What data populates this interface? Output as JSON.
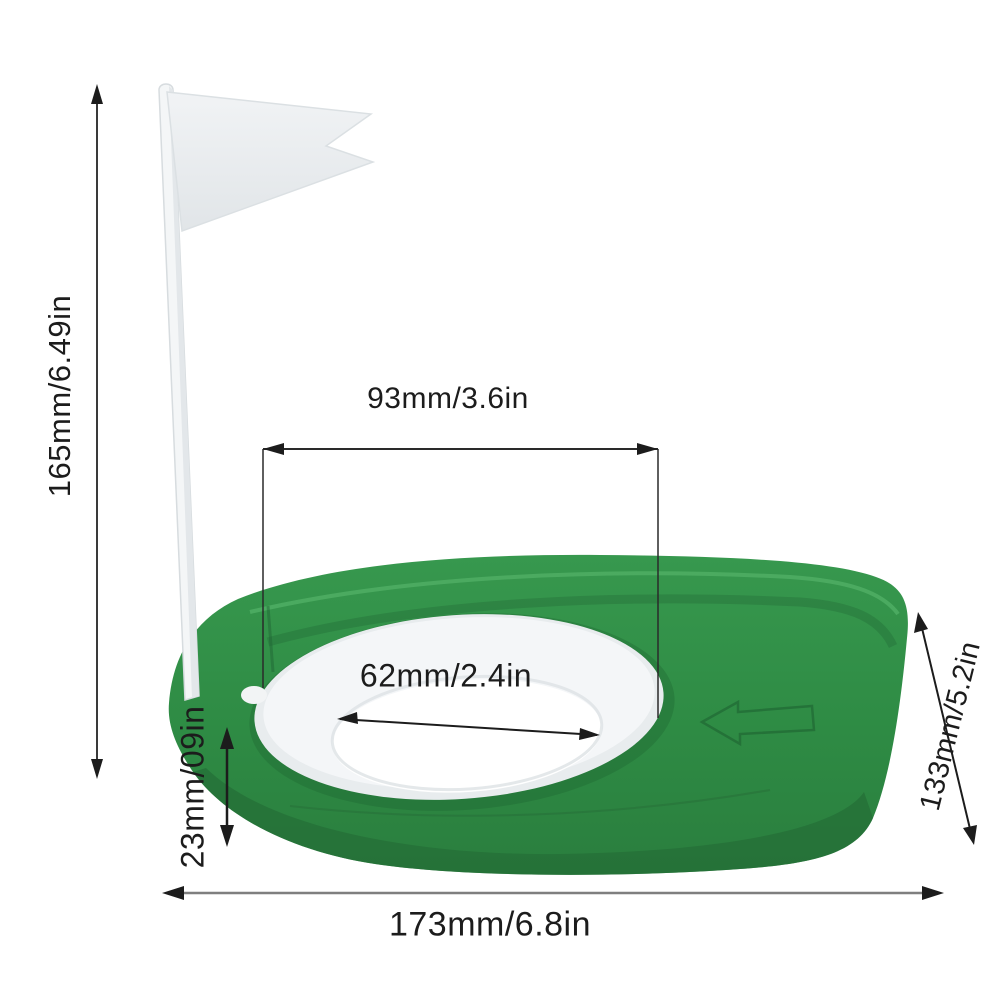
{
  "scene": {
    "type": "product-dimension-diagram",
    "product": "golf putting practice cup with flag",
    "background_color": "#ffffff",
    "colors": {
      "base_green": "#2e8b44",
      "base_green_dark": "#256d37",
      "base_green_light": "#45a55b",
      "ring_white": "#eef1f3",
      "hole_white": "#ffffff",
      "flag_white": "#eceff1",
      "pole_white": "#f4f6f7",
      "dimension_line": "#1c1c1c",
      "width_line_gray": "#7f7f7f"
    }
  },
  "labels": {
    "height": "165mm/6.49in",
    "hole_spacing": "93mm/3.6in",
    "hole_diameter": "62mm/2.4in",
    "edge_height": "23mm/09in",
    "depth": "133mm/5.2in",
    "width": "173mm/6.8in"
  }
}
